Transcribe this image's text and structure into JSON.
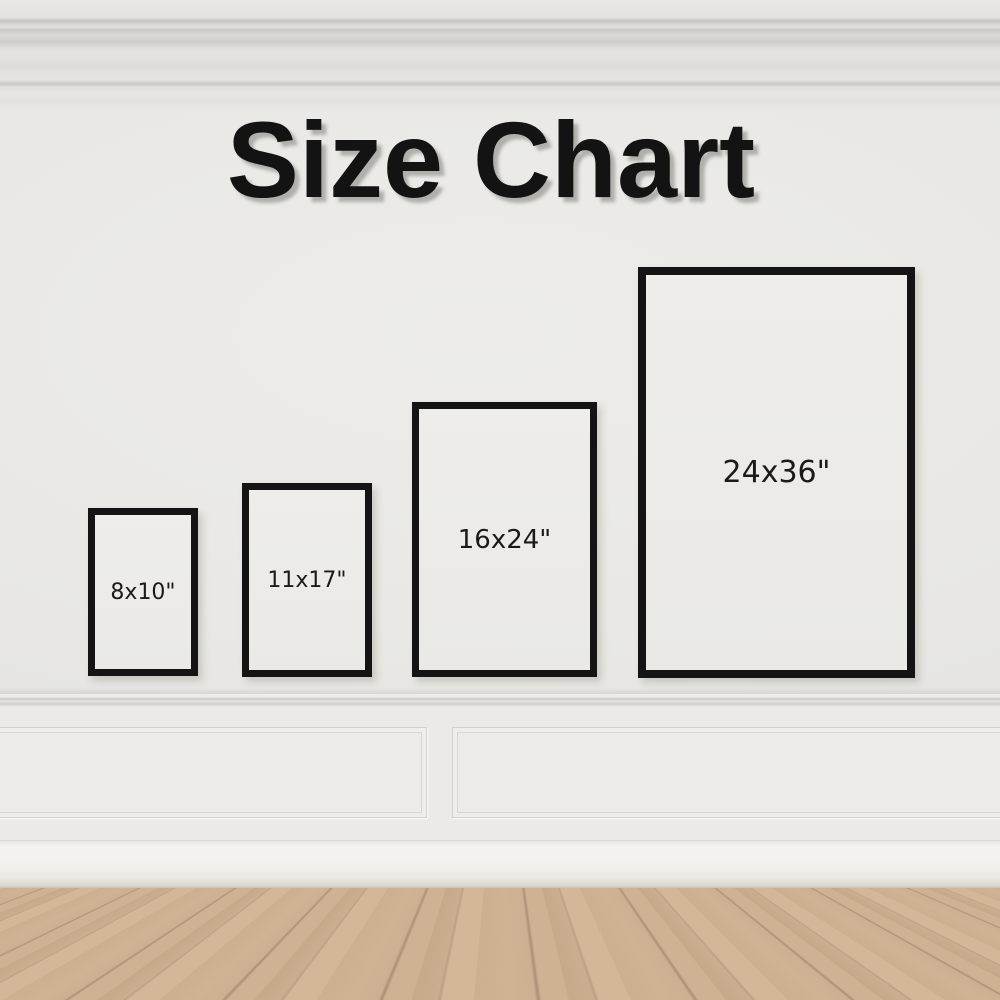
{
  "title": "Size Chart",
  "frames": [
    {
      "name": "8x10",
      "label": "8x10\""
    },
    {
      "name": "11x17",
      "label": "11x17\""
    },
    {
      "name": "16x24",
      "label": "16x24\""
    },
    {
      "name": "24x36",
      "label": "24x36\""
    }
  ],
  "colors": {
    "frame_border": "#141414",
    "title_text": "#131313",
    "wall": "#e9e8e4",
    "wainscot_panel": "#ecebe7",
    "baseboard": "#f2f1ed",
    "floor_wood": "#c9ab8e"
  }
}
